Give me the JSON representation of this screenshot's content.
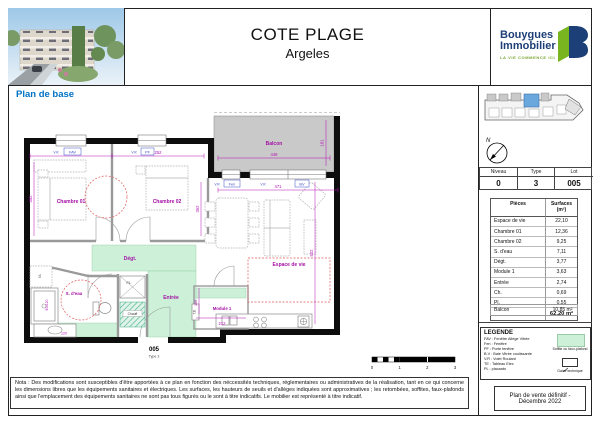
{
  "header": {
    "title": "COTE PLAGE",
    "subtitle": "Argeles",
    "logo_line1": "Bouygues",
    "logo_line2": "Immobilier",
    "logo_tagline": "LA VIE COMMENCE ICI"
  },
  "plan_title": "Plan de base",
  "plan": {
    "rooms": {
      "chambre01": "Chambre 01",
      "chambre02": "Chambre 02",
      "balcon": "Balcon",
      "espace_de_vie": "Espace de vie",
      "degt": "Dégt.",
      "sdeau": "S. d'eau",
      "entree": "Entrée",
      "module1": "Module 1"
    },
    "annotations": {
      "pl": "PL.",
      "chauff": "Chauff",
      "te": "T.E",
      "ml": "ML"
    },
    "windows": {
      "fav": "FAV",
      "pf": "PF",
      "fen": "Fen",
      "bv": "BV",
      "vr": "V.R"
    },
    "dims": {
      "d342": "342",
      "d252": "252",
      "d471": "471",
      "d448": "448",
      "d181": "181",
      "d352": "352",
      "d362": "362",
      "d502": "502",
      "d212": "212",
      "d169": "169",
      "d120": "120",
      "d90120": "90x120"
    },
    "lot": {
      "number": "005",
      "type": "Type 3"
    }
  },
  "scale": {
    "ticks": [
      "0",
      "1",
      "2",
      "3"
    ]
  },
  "sidebar": {
    "compass": "N",
    "unit_table": {
      "headers": [
        "Niveau",
        "Type",
        "Lot"
      ],
      "values": [
        "0",
        "3",
        "005"
      ]
    },
    "surfaces": {
      "header": [
        "Pièces",
        "Surfaces (m²)"
      ],
      "rows": [
        [
          "Espace de vie",
          "22,10"
        ],
        [
          "Chambre 01",
          "12,36"
        ],
        [
          "Chambre 02",
          "9,25"
        ],
        [
          "S. d'eau",
          "7,11"
        ],
        [
          "Dégt.",
          "3,77"
        ],
        [
          "Module 1",
          "3,63"
        ],
        [
          "Entrée",
          "2,74"
        ],
        [
          "Ch.",
          "0,69"
        ],
        [
          "Pl.",
          "0,55"
        ]
      ],
      "total": "62,20 m²",
      "balcon": [
        "Balcon",
        "10,85 m²"
      ]
    },
    "legend": {
      "title": "LEGENDE",
      "items": [
        "FAV : Fenêtre Allège Vitrée",
        "Fen : Fenêtre",
        "PF : Porte fenêtre",
        "B.V : Baie Vitrée coulissante",
        "V.R : Volet Roulant",
        "TE : Tableau Elec",
        "PL : placards"
      ],
      "swatch_label": "Soffite ou faux-plafond",
      "gaine_label": "Gaine technique"
    },
    "stamp": "Plan de vente définitif - Décembre 2022"
  },
  "nota": "Nota : Des modifications sont susceptibles d'être apportées à ce plan en fonction des néccessités techniques, réglementaires ou administratives de la réalisation, tant en ce qui concerne les dimensions libres que les équipements sanitaires et électriques. Les surfaces, les hauteurs de seuils et d'allèges indiquées sont approximatives ; les retombées, soffites, faux-plafonds ainsi que l'emplacement des équipements sanitaires ne sont pas tous figurés ou le sont à titre indicatifs. Le mobilier est représenté à titre indicatif."
}
